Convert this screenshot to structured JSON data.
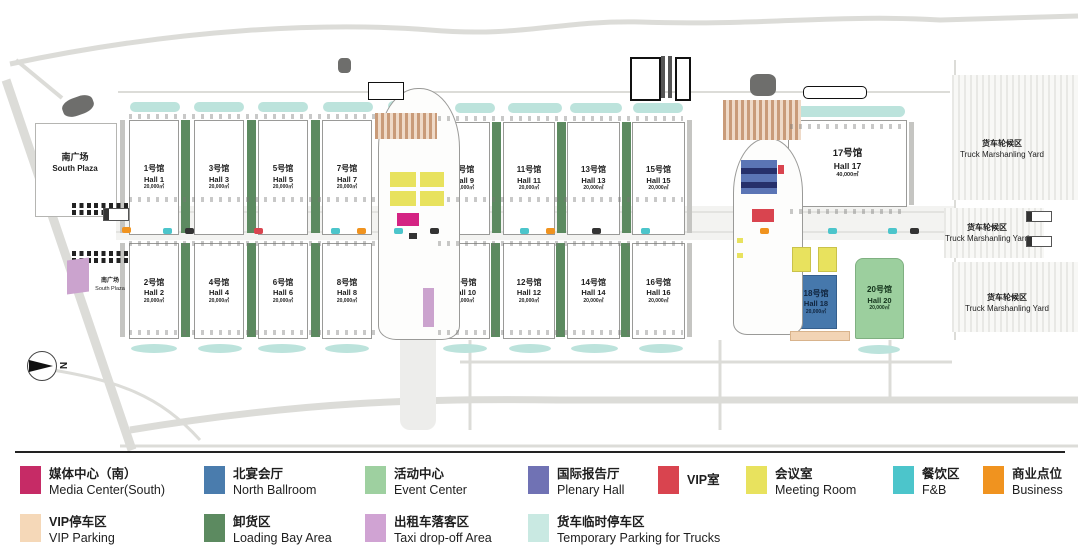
{
  "plan": {
    "south_plaza": {
      "cn": "南广场",
      "en": "South Plaza"
    },
    "south_plaza_small": {
      "cn": "南广场",
      "en": "South Plaza"
    },
    "compass": "N",
    "truck_yard": {
      "cn": "货车轮候区",
      "en": "Truck Marshanling Yard"
    },
    "halls": {
      "h1": {
        "cn": "1号馆",
        "en": "Hall 1",
        "area": "20,000㎡"
      },
      "h2": {
        "cn": "2号馆",
        "en": "Hall 2",
        "area": "20,000㎡"
      },
      "h3": {
        "cn": "3号馆",
        "en": "Hall 3",
        "area": "20,000㎡"
      },
      "h4": {
        "cn": "4号馆",
        "en": "Hall 4",
        "area": "20,000㎡"
      },
      "h5": {
        "cn": "5号馆",
        "en": "Hall 5",
        "area": "20,000㎡"
      },
      "h6": {
        "cn": "6号馆",
        "en": "Hall 6",
        "area": "20,000㎡"
      },
      "h7": {
        "cn": "7号馆",
        "en": "Hall 7",
        "area": "20,000㎡"
      },
      "h8": {
        "cn": "8号馆",
        "en": "Hall 8",
        "area": "20,000㎡"
      },
      "h9": {
        "cn": "9号馆",
        "en": "Hall 9",
        "area": "20,000㎡"
      },
      "h10": {
        "cn": "10号馆",
        "en": "Hall 10",
        "area": "20,000㎡"
      },
      "h11": {
        "cn": "11号馆",
        "en": "Hall 11",
        "area": "20,000㎡"
      },
      "h12": {
        "cn": "12号馆",
        "en": "Hall 12",
        "area": "20,000㎡"
      },
      "h13": {
        "cn": "13号馆",
        "en": "Hall 13",
        "area": "20,000㎡"
      },
      "h14": {
        "cn": "14号馆",
        "en": "Hall 14",
        "area": "20,000㎡"
      },
      "h15": {
        "cn": "15号馆",
        "en": "Hall 15",
        "area": "20,000㎡"
      },
      "h16": {
        "cn": "16号馆",
        "en": "Hall 16",
        "area": "20,000㎡"
      },
      "h17": {
        "cn": "17号馆",
        "en": "Hall 17",
        "area": "40,000㎡"
      },
      "h18": {
        "cn": "18号馆",
        "en": "Hall 18",
        "area": "20,000㎡"
      },
      "h20": {
        "cn": "20号馆",
        "en": "Hall 20",
        "area": "20,000㎡"
      }
    }
  },
  "legend": {
    "row1": [
      {
        "cn": "媒体中心（南）",
        "en": "Media Center(South)",
        "color": "#C62B66"
      },
      {
        "cn": "北宴会厅",
        "en": "North Ballroom",
        "color": "#4A7CAD"
      },
      {
        "cn": "活动中心",
        "en": "Event Center",
        "color": "#9ED0A0"
      },
      {
        "cn": "国际报告厅",
        "en": "Plenary Hall",
        "color": "#7072B4"
      },
      {
        "cn": "VIP室",
        "en": "",
        "color": "#D9444F"
      },
      {
        "cn": "会议室",
        "en": "Meeting Room",
        "color": "#E8E25E"
      },
      {
        "cn": "餐饮区",
        "en": "F&B",
        "color": "#4CC5CB"
      },
      {
        "cn": "商业点位",
        "en": "Business",
        "color": "#F0931F"
      }
    ],
    "row2": [
      {
        "cn": "VIP停车区",
        "en": "VIP Parking",
        "color": "#F5D8B8"
      },
      {
        "cn": "卸货区",
        "en": "Loading Bay Area",
        "color": "#5C8A60"
      },
      {
        "cn": "出租车落客区",
        "en": "Taxi drop-off Area",
        "color": "#D0A3D3"
      },
      {
        "cn": "货车临时停车区",
        "en": "Temporary Parking for Trucks",
        "color": "#C9E9E2"
      }
    ]
  }
}
